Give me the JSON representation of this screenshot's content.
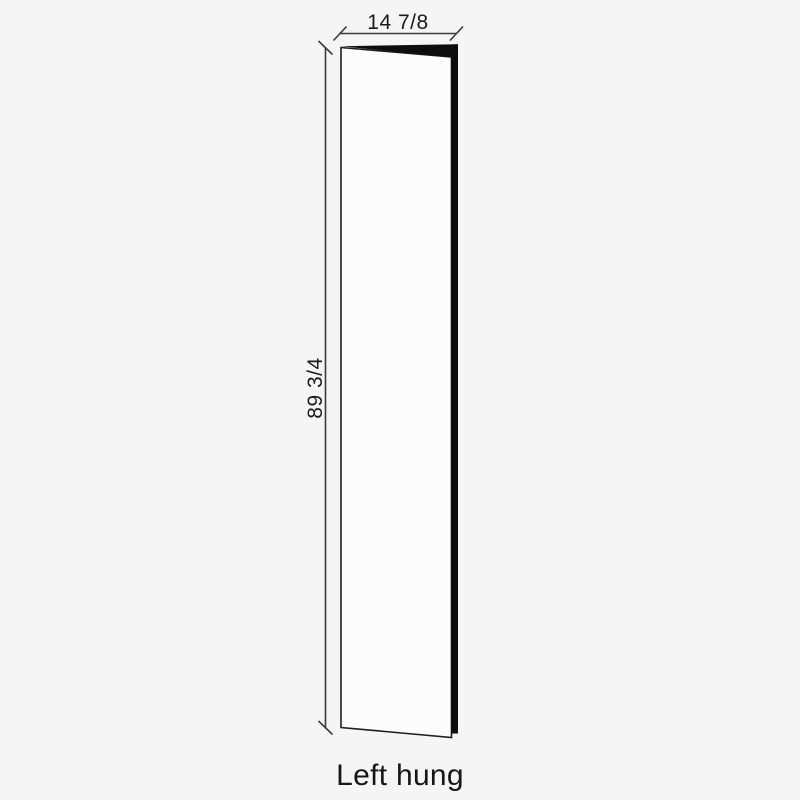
{
  "page": {
    "background_color": "#f5f5f5"
  },
  "diagram": {
    "type": "door-elevation-drawing",
    "caption": "Left hung",
    "dimensions": {
      "width": {
        "label": "14 7/8"
      },
      "height": {
        "label": "89 3/4"
      }
    },
    "colors": {
      "dimension_line": "#3a3a3a",
      "door_outline": "#1d1d1d",
      "door_fill": "#fcfcfc",
      "door_edge_fill": "#0d0d0d",
      "text": "#1b1b1b"
    }
  }
}
